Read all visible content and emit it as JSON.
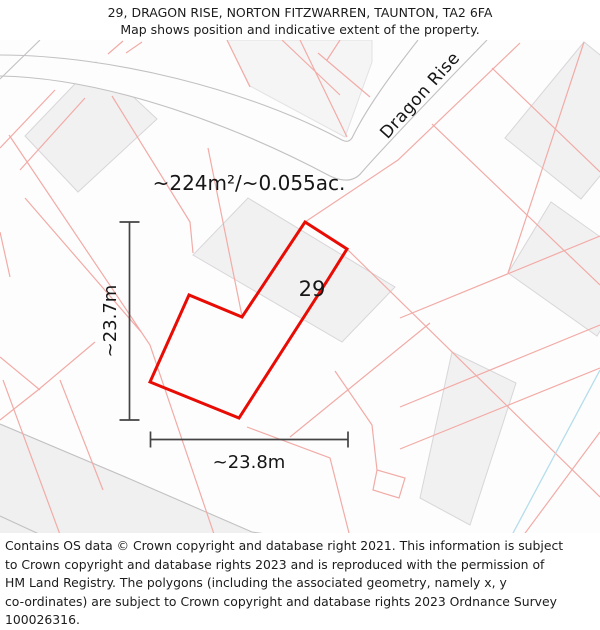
{
  "title": {
    "line1": "29, DRAGON RISE, NORTON FITZWARREN, TAUNTON, TA2 6FA",
    "line2": "Map shows position and indicative extent of the property."
  },
  "map": {
    "street_label": "Dragon Rise",
    "area_label": "~224m²/~0.055ac.",
    "plot_number": "29",
    "dim_vertical": "~23.7m",
    "dim_horizontal": "~23.8m",
    "colors": {
      "plot_outline": "#e80c04",
      "parcel_line": "#f2aba6",
      "building_fill": "#f2f1f2",
      "building_stroke": "#d8d6d8",
      "road_edge": "#c2c0c2",
      "road_fill": "#f1f0f1",
      "dimension": "#434343",
      "water_line": "#b5ddec",
      "street_label_color": "#a6a4a6"
    }
  },
  "footer": {
    "line1": "Contains OS data © Crown copyright and database right 2021. This information is subject",
    "line2": "to Crown copyright and database rights 2023 and is reproduced with the permission of",
    "line3": "HM Land Registry. The polygons (including the associated geometry, namely x, y",
    "line4": "co-ordinates) are subject to Crown copyright and database rights 2023 Ordnance Survey",
    "line5": "100026316."
  }
}
